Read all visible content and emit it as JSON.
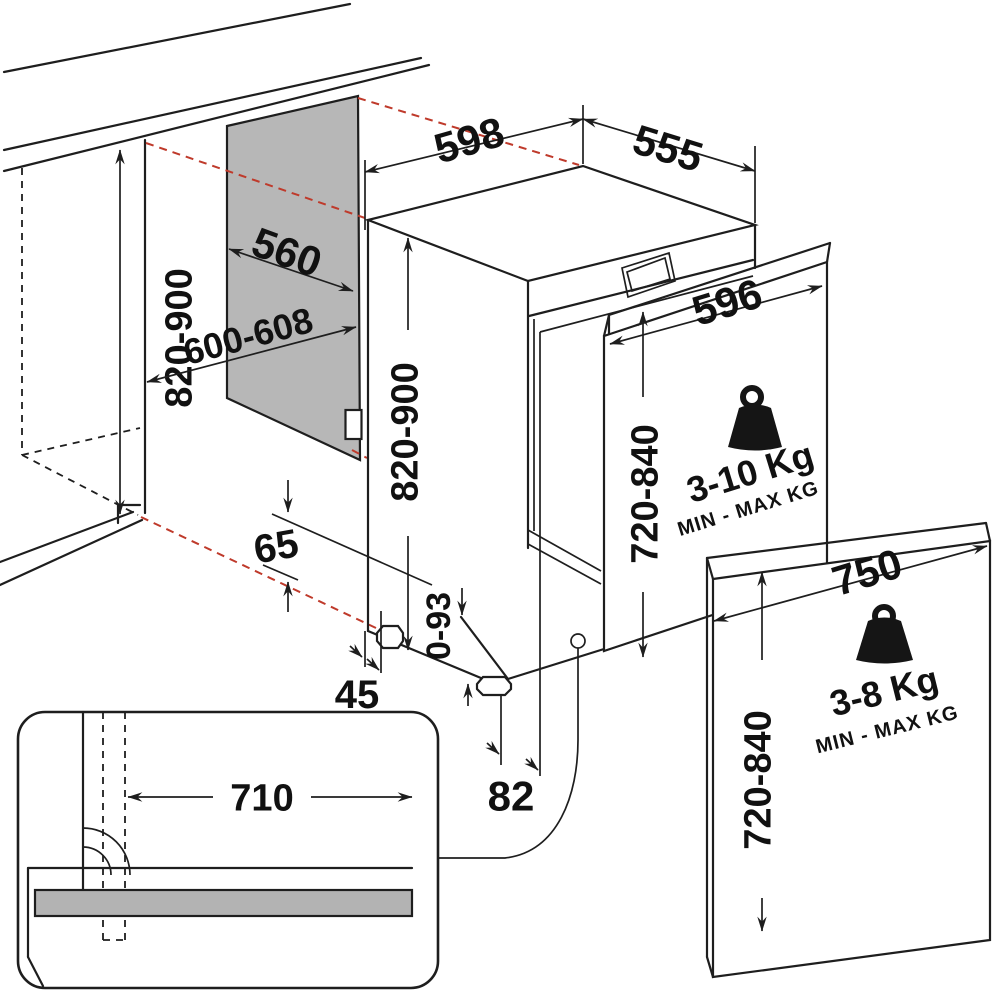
{
  "title": "Built-in dishwasher installation dimensions diagram",
  "units": "mm",
  "colors": {
    "line": "#1e1e1e",
    "alignment_dash_red": "#bf3a2b",
    "niche_panel_gray": "#b7b7b7",
    "plinth_strip_gray": "#b3b3b3",
    "background": "#ffffff"
  },
  "dimensions": {
    "niche": {
      "height": "820-900",
      "width": "600-608",
      "depth": "560"
    },
    "dishwasher": {
      "width": "598",
      "depth": "555",
      "height": "820-900",
      "adjustable_feet_height": "0-93",
      "side_clearance": "45",
      "base_clearance": "65",
      "drain_position": "82"
    },
    "plinth_cutout_width": "710"
  },
  "panels": {
    "standard_door": {
      "width": "596",
      "height": "720-840",
      "weight_range": "3-10 Kg",
      "weight_caption": "MIN - MAX KG"
    },
    "xl_door": {
      "width": "750",
      "height": "720-840",
      "weight_range": "3-8 Kg",
      "weight_caption": "MIN - MAX KG"
    }
  }
}
